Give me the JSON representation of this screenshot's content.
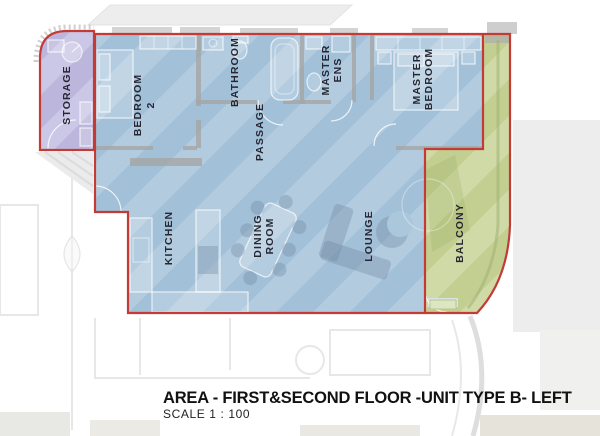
{
  "title": {
    "heading": "AREA - FIRST&SECOND FLOOR -UNIT TYPE B- LEFT",
    "scale": "SCALE 1 : 100"
  },
  "rooms": {
    "storage": {
      "label": "STORAGE"
    },
    "bedroom2": {
      "line1": "BEDROOM",
      "line2": "2"
    },
    "bathroom": {
      "label": "BATHROOM"
    },
    "master_ens": {
      "line1": "MASTER",
      "line2": "ENS"
    },
    "master_bedroom": {
      "line1": "MASTER",
      "line2": "BEDROOM"
    },
    "passage": {
      "label": "PASSAGE"
    },
    "kitchen": {
      "label": "KITCHEN"
    },
    "dining": {
      "line1": "DINING",
      "line2": "ROOM"
    },
    "lounge": {
      "label": "LOUNGE"
    },
    "balcony": {
      "label": "BALCONY"
    }
  },
  "colors": {
    "unit_fill": "#b2cbdf",
    "unit_stripe": "#a2c0d8",
    "storage_fill": "#cbc7e6",
    "storage_stripe": "#bdb6dc",
    "balcony_fill": "#cfdaa6",
    "balcony_stripe": "#c2cf90",
    "outline": "#c23b35",
    "wall": "#a5a5a5",
    "label_ink": "#262733"
  }
}
